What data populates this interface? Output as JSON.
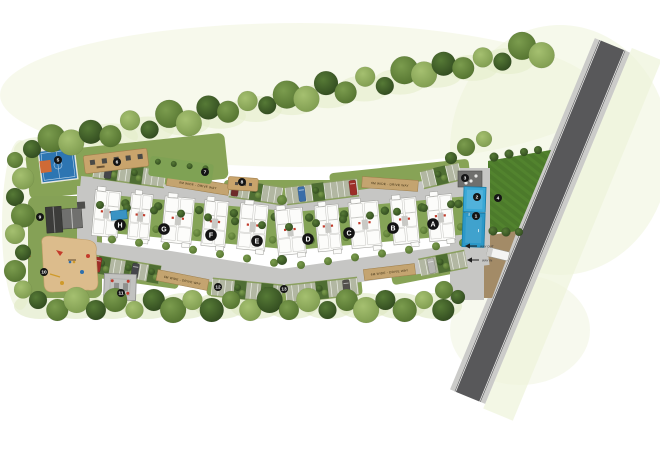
{
  "blocks": [
    {
      "label": "A"
    },
    {
      "label": "B"
    },
    {
      "label": "C"
    },
    {
      "label": "D"
    },
    {
      "label": "E"
    },
    {
      "label": "F"
    },
    {
      "label": "G"
    },
    {
      "label": "H"
    }
  ],
  "amenities": [
    {
      "num": "1",
      "name": "swimming-pool"
    },
    {
      "num": "2",
      "name": "kids-pool"
    },
    {
      "num": "3",
      "name": "pool-pavilion"
    },
    {
      "num": "4",
      "name": "lawn"
    },
    {
      "num": "5",
      "name": "basketball-court"
    },
    {
      "num": "6",
      "name": "outdoor-gym"
    },
    {
      "num": "7",
      "name": "lawn-strip"
    },
    {
      "num": "8",
      "name": "seating-area"
    },
    {
      "num": "9",
      "name": "clubhouse"
    },
    {
      "num": "10",
      "name": "kids-play-area"
    },
    {
      "num": "11",
      "name": "party-pavilion"
    },
    {
      "num": "12",
      "name": "south-lawn"
    },
    {
      "num": "13",
      "name": "south-green"
    }
  ],
  "road_bands": [
    {
      "text": "6M WIDE - DRIVE WAY"
    },
    {
      "text": "6M WIDE - DRIVE WAY"
    },
    {
      "text": "6M WIDE - DRIVE WAY"
    },
    {
      "text": "6M WIDE - DRIVE WAY"
    }
  ],
  "entry": {
    "way_out": "WAY OUT",
    "way_in": "WAY IN"
  },
  "colors": {
    "loop_road": "#c6c6c4",
    "main_road": "#58585a",
    "curb": "#cbcbc9",
    "building": "#fcfcfa",
    "courtyard": "#85a457",
    "lawn": "#4c7a2a",
    "pool": "#2b98c8",
    "kids_pool": "#3aa8d6",
    "court_blue": "#2d75b2",
    "court_orange": "#cf6a36",
    "tan_band": "#c4a470",
    "playground": "#dcbc8c",
    "entry_ground": "#a38b67",
    "accent_red": "#c13b2b",
    "badge": "#141414"
  }
}
